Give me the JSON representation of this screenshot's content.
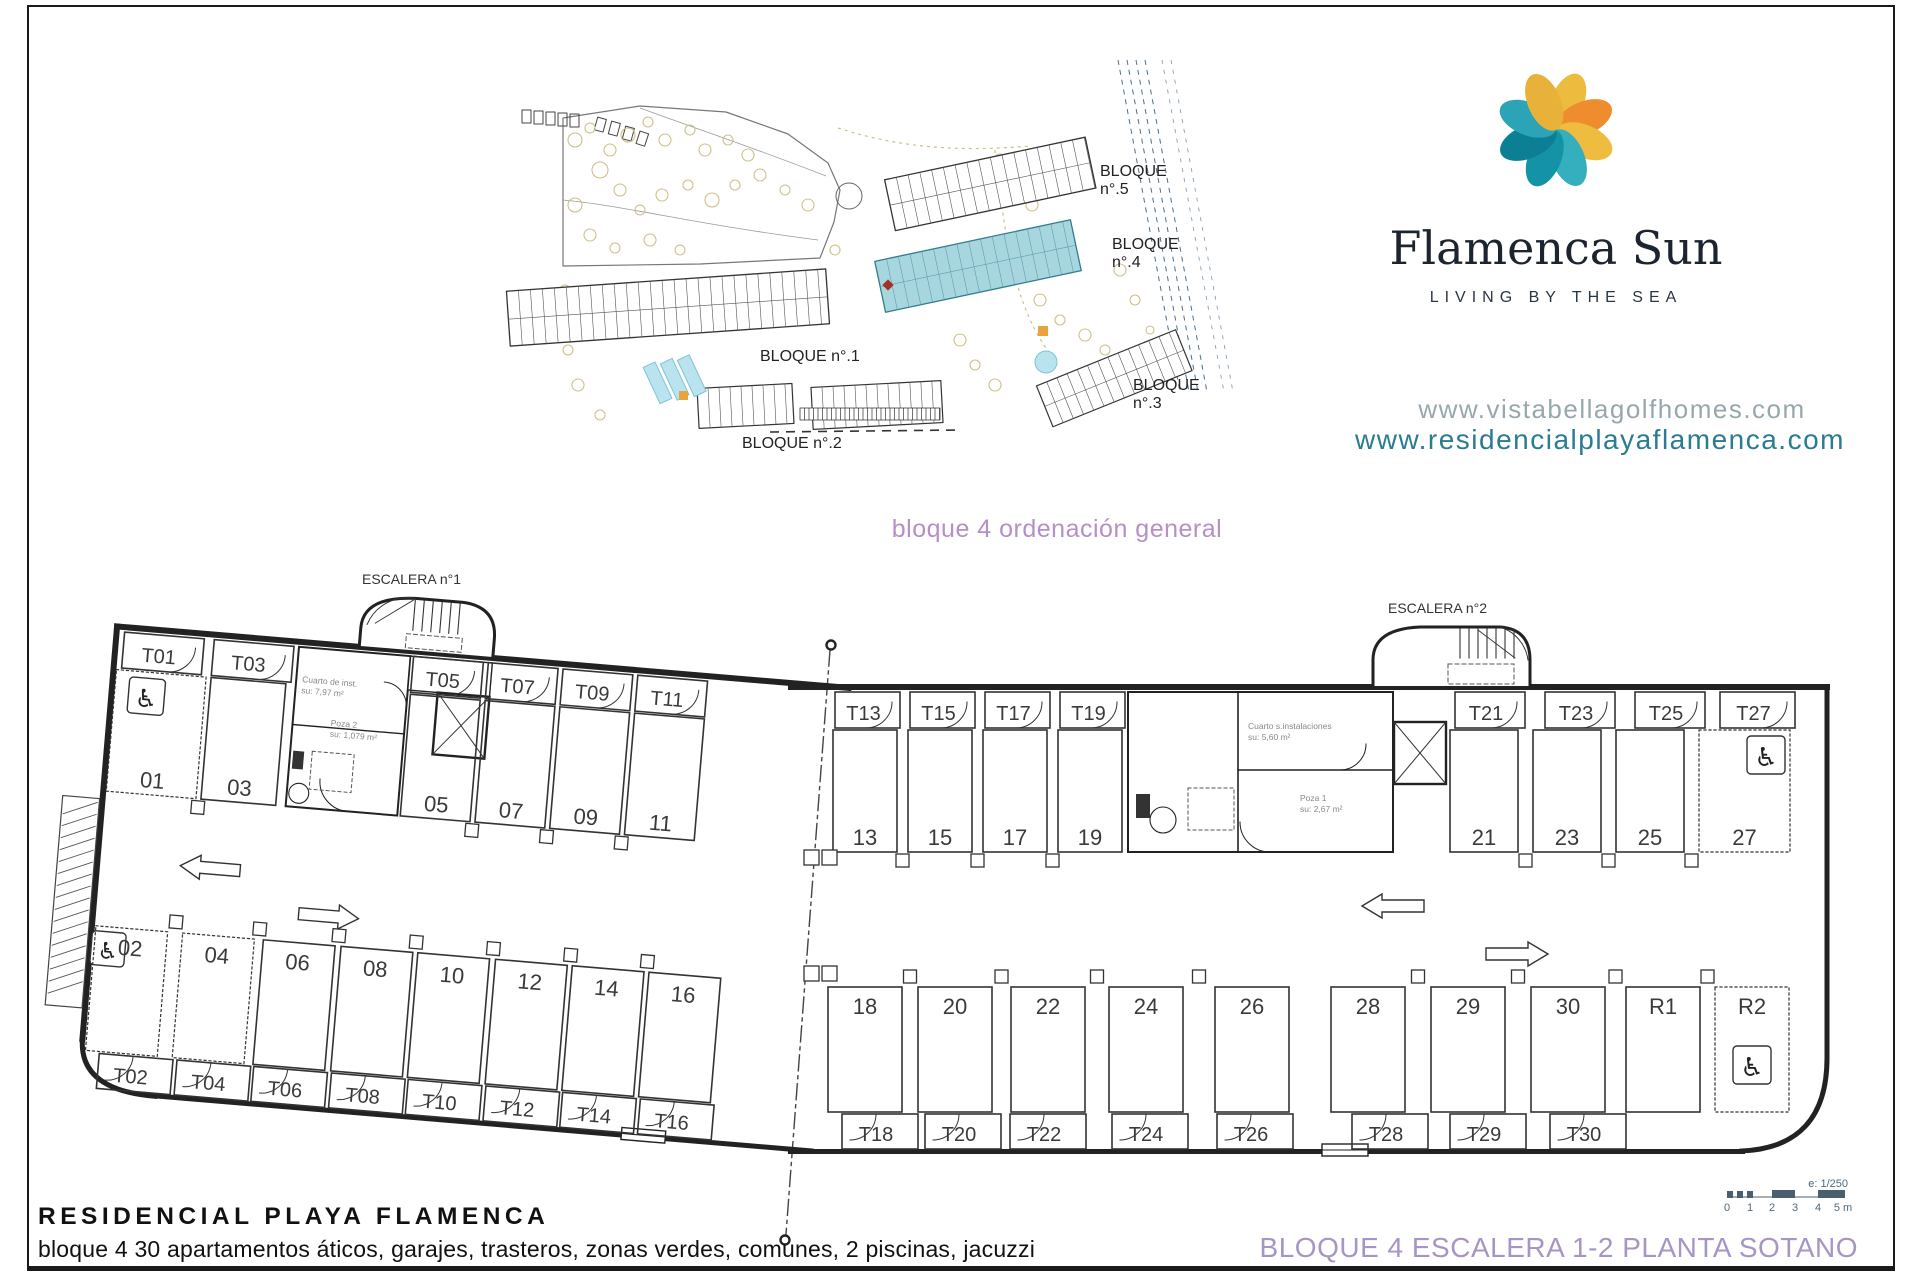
{
  "site_plan": {
    "bloque5_line1": "BLOQUE",
    "bloque5_line2": "n°.5",
    "bloque4_line1": "BLOQUE",
    "bloque4_line2": "n°.4",
    "bloque1": "BLOQUE n°.1",
    "bloque2": "BLOQUE n°.2",
    "bloque3_line1": "BLOQUE",
    "bloque3_line2": "n°.3",
    "highlight_color": "#a8d6de"
  },
  "brand": {
    "name": "Flamenca Sun",
    "tagline": "LIVING BY THE SEA",
    "url_primary": "www.vistabellagolfhomes.com",
    "url_secondary": "www.residencialplayaflamenca.com",
    "url_primary_color": "#97a8ad",
    "url_secondary_color": "#2a7c90",
    "petal_colors": [
      "#edbc3e",
      "#ee8c2e",
      "#eebc3e",
      "#35aebe",
      "#1593a6",
      "#0d7f94",
      "#2aa4b6",
      "#e8b23a"
    ]
  },
  "caption": {
    "text": "bloque 4 ordenación general",
    "color": "#b48fc8"
  },
  "plan": {
    "escalera1": "ESCALERA n°1",
    "escalera2": "ESCALERA n°2",
    "top_storage_left": [
      "T01",
      "T03",
      "T05",
      "T07",
      "T09",
      "T11"
    ],
    "top_stalls_left": [
      "01",
      "03",
      "05",
      "07",
      "09",
      "11"
    ],
    "bottom_stalls_left": [
      "02",
      "04",
      "06",
      "08",
      "10",
      "12",
      "14",
      "16"
    ],
    "bottom_storage_left": [
      "T02",
      "T04",
      "T06",
      "T08",
      "T10",
      "T12",
      "T14",
      "T16"
    ],
    "top_storage_right": [
      "T13",
      "T15",
      "T17",
      "T19",
      "T21",
      "T23",
      "T25",
      "T27"
    ],
    "top_stalls_right": [
      "13",
      "15",
      "17",
      "19",
      "21",
      "23",
      "25",
      "27"
    ],
    "bottom_stalls_right": [
      "18",
      "20",
      "22",
      "24",
      "26",
      "28",
      "29",
      "30",
      "R1",
      "R2"
    ],
    "bottom_storage_right": [
      "T18",
      "T20",
      "T22",
      "T24",
      "T26",
      "T28",
      "T29",
      "T30"
    ],
    "notes": [
      "Cuarto de inst.",
      "su: 7,97 m²",
      "Poza 2",
      "su: 1,079 m²",
      "Cuarto s.instalaciones",
      "su: 5,60 m²",
      "Poza 1",
      "su: 2,67 m²"
    ],
    "handicap_symbol": "♿"
  },
  "footer": {
    "title": "RESIDENCIAL PLAYA FLAMENCA",
    "subtitle": "bloque 4 30 apartamentos áticos, garajes, trasteros, zonas verdes, comunes, 2 piscinas, jacuzzi",
    "sheet_title": "BLOQUE 4 ESCALERA 1-2 PLANTA SOTANO",
    "sheet_title_color": "#a795c5",
    "scale_label": "e: 1/250",
    "scale_ticks": [
      "0",
      "1",
      "2",
      "3",
      "4",
      "5 m"
    ]
  }
}
